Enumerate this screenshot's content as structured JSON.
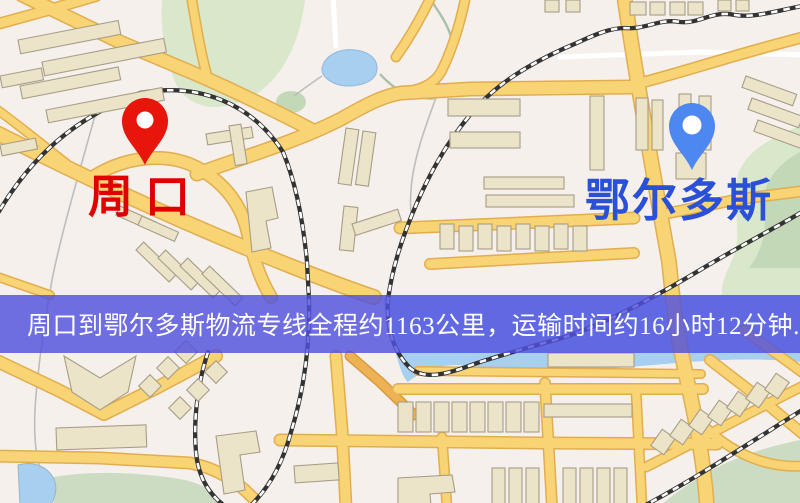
{
  "banner": {
    "text": "周口到鄂尔多斯物流专线全程约1163公里，运输时间约16小时12分钟.",
    "distance_km": "1163",
    "duration": "16小时12分钟",
    "background_color": "#5050de",
    "text_color": "#ffffff"
  },
  "markers": {
    "origin": {
      "name": "周口",
      "pin_color": "#e8150b",
      "pin_hole_color": "#ffffff",
      "label_color": "#e00000"
    },
    "destination": {
      "name": "鄂尔多斯",
      "pin_color": "#4d87f0",
      "pin_hole_color": "#ffffff",
      "label_color": "#2b50d8"
    }
  },
  "map_palette": {
    "background": "#f6f0ec",
    "road_fill": "#f8d474",
    "road_casing": "#e2ad4f",
    "park_green": "#d9e7ca",
    "water_blue": "#a6cff0",
    "railway_dark": "#333333",
    "railway_light": "#ffffff",
    "building_fill": "#ece4c8",
    "building_stroke": "#a79d88"
  }
}
